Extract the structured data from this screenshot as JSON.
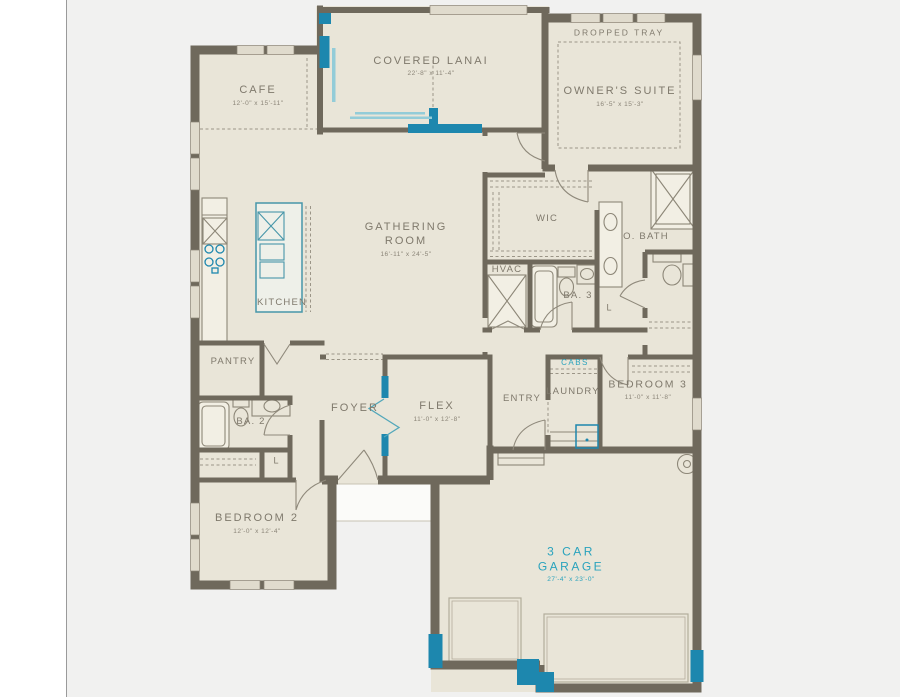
{
  "palette": {
    "background": "#f1f1f0",
    "sidebar": "#ffffff",
    "floor": "#e9e5d8",
    "wall": "#6f695c",
    "accent": "#1d87ae",
    "accent_light": "#93ccd8",
    "label_text": "#7f796c",
    "teal_text": "#2aa3bd"
  },
  "rooms": {
    "cafe": {
      "name": "CAFE",
      "dims": "12'-0\" x 15'-11\""
    },
    "lanai": {
      "name": "COVERED LANAI",
      "dims": "22'-8\" x 11'-4\""
    },
    "owners_suite": {
      "name": "OWNER'S SUITE",
      "dims": "16'-5\" x 15'-3\""
    },
    "gathering": {
      "line1": "GATHERING",
      "line2": "ROOM",
      "dims": "16'-11\" x 24'-5\""
    },
    "wic": {
      "name": "WIC"
    },
    "obath": {
      "name": "O. BATH"
    },
    "kitchen": {
      "name": "KITCHEN"
    },
    "hvac": {
      "name": "HVAC"
    },
    "ba3": {
      "name": "BA. 3"
    },
    "pantry": {
      "name": "PANTRY"
    },
    "laundry": {
      "name": "LAUNDRY"
    },
    "bedroom3": {
      "name": "BEDROOM 3",
      "dims": "11'-0\" x 11'-8\""
    },
    "entry": {
      "name": "ENTRY"
    },
    "ba2": {
      "name": "BA. 2"
    },
    "foyer": {
      "name": "FOYER"
    },
    "flex": {
      "name": "FLEX",
      "dims": "11'-0\" x 12'-8\""
    },
    "bedroom2": {
      "name": "BEDROOM 2",
      "dims": "12'-0\" x 12'-4\""
    },
    "garage": {
      "line1": "3 CAR",
      "line2": "GARAGE",
      "dims": "27'-4\" x 23'-0\""
    }
  },
  "annotations": {
    "dropped_tray": "DROPPED TRAY",
    "cabs": "CABS",
    "linen_ba2": "L",
    "linen_obath": "L"
  }
}
